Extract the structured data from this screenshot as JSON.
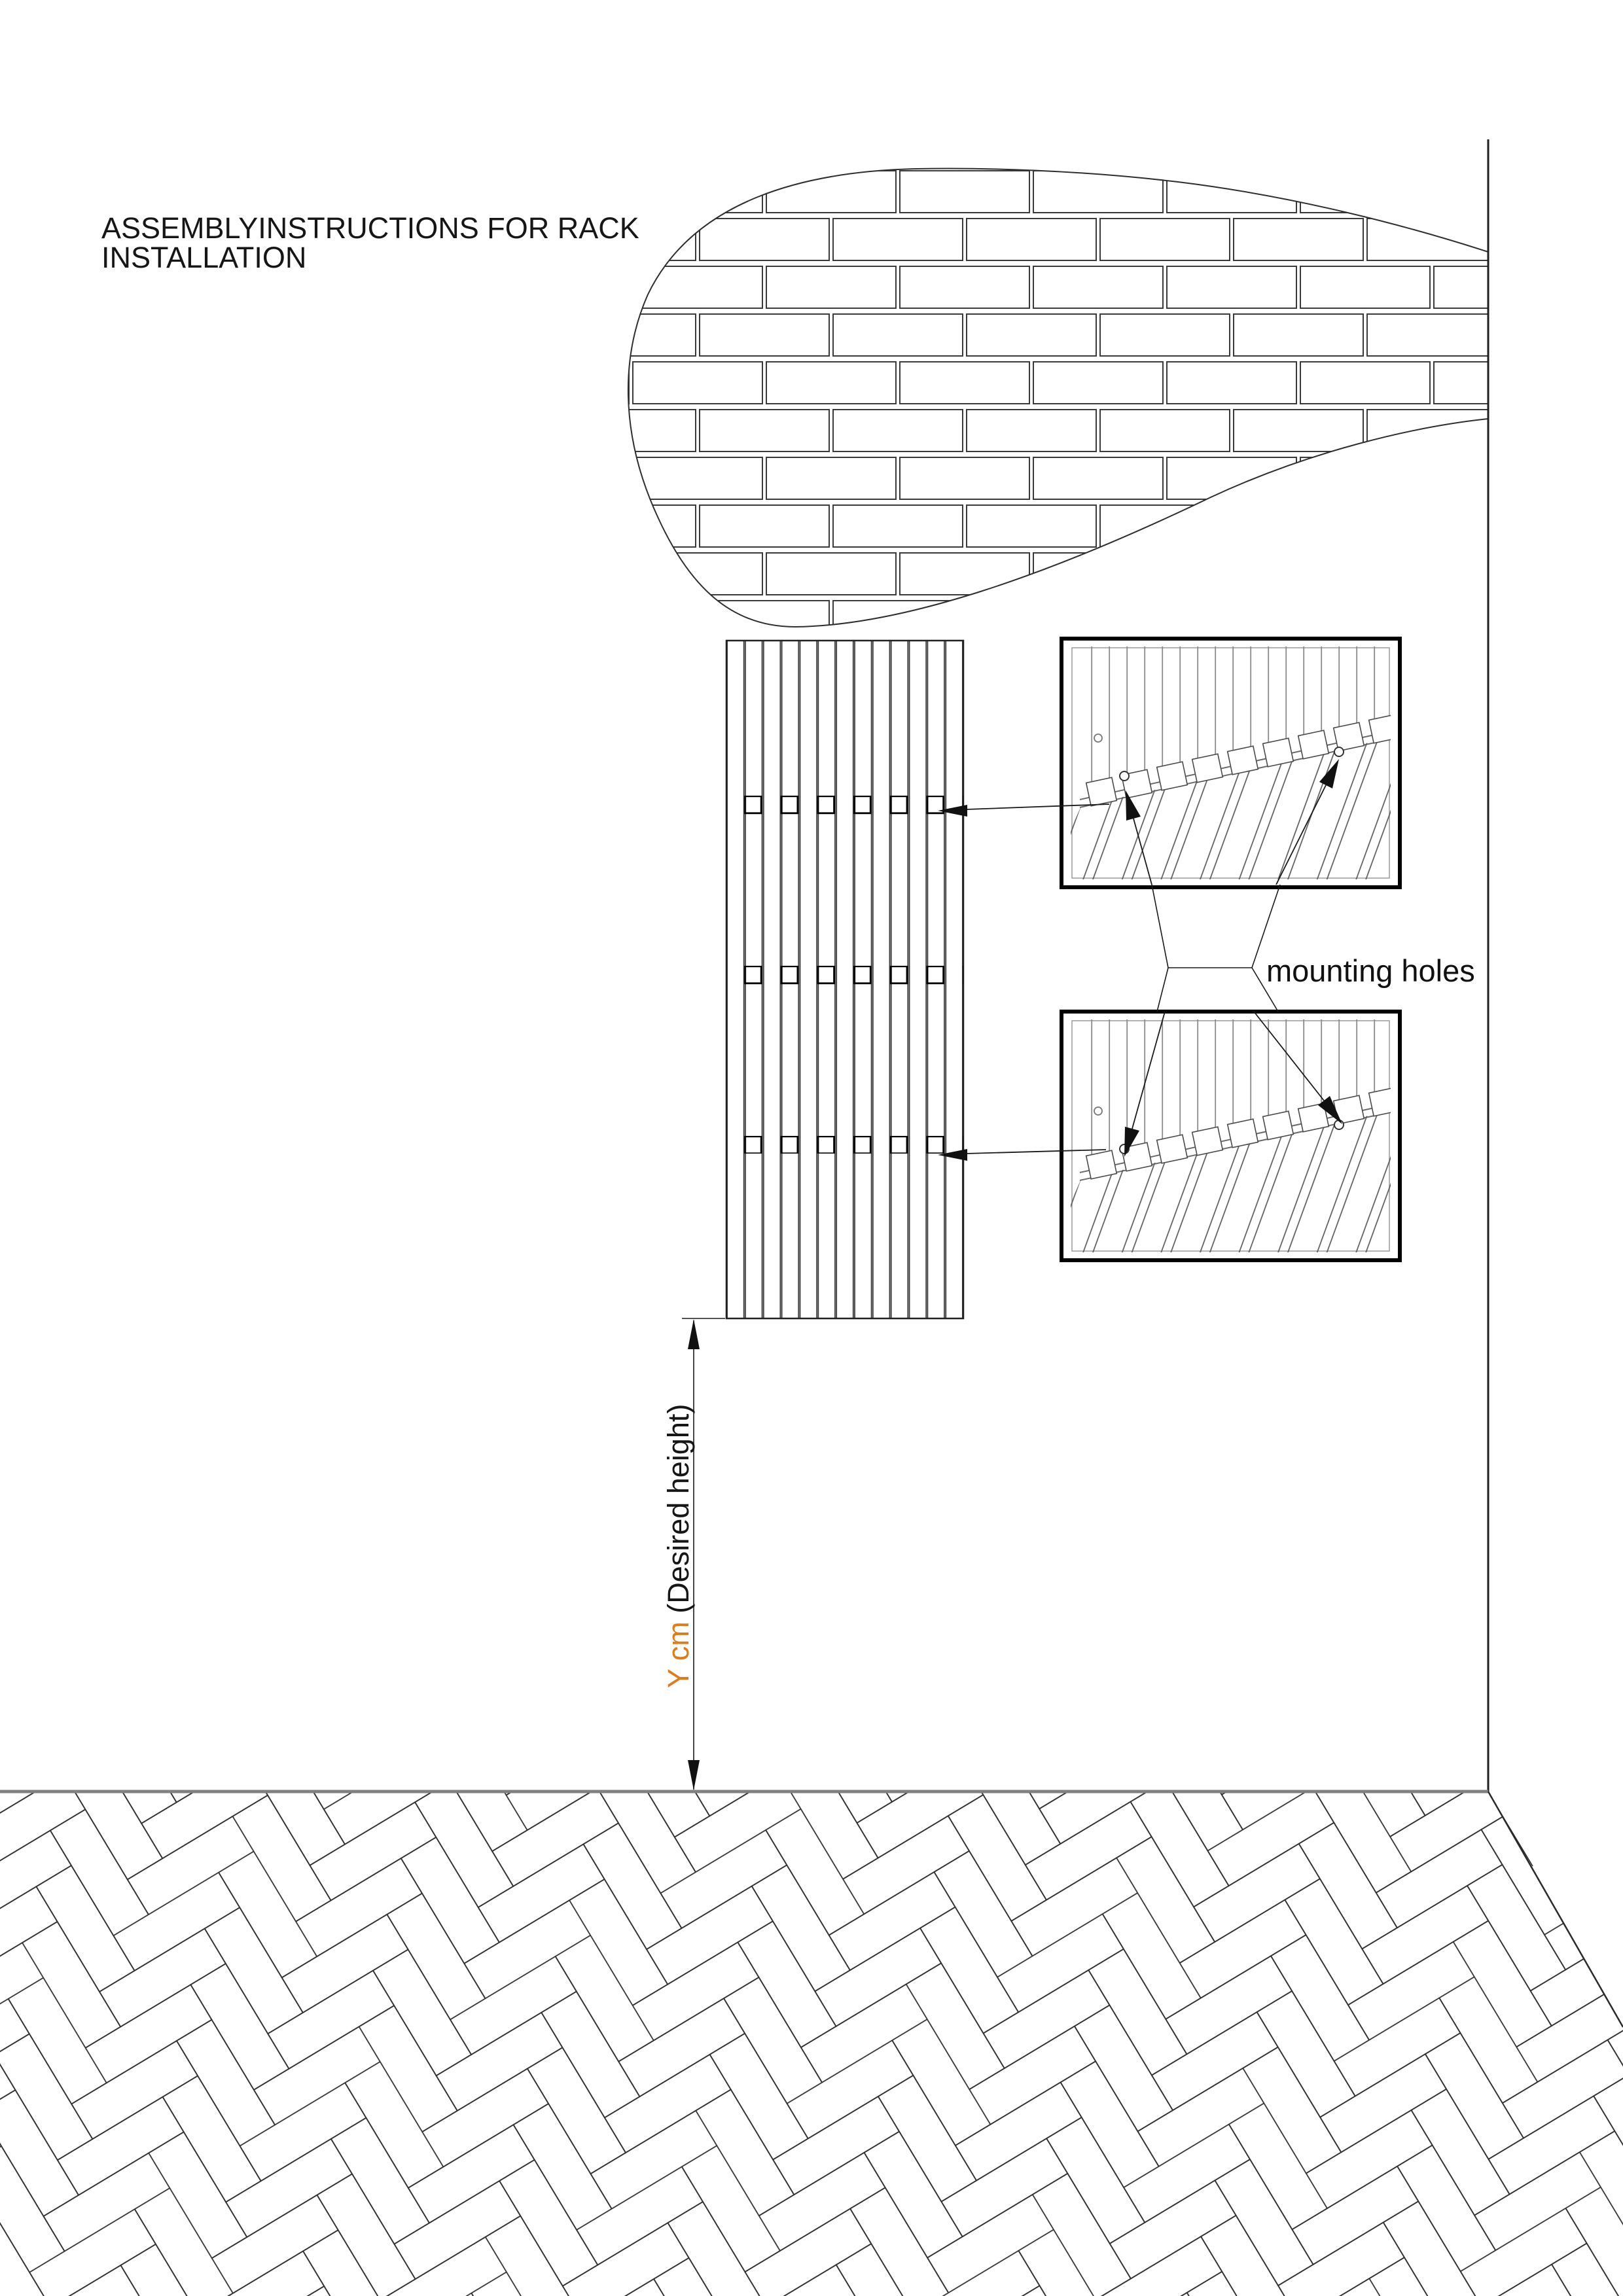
{
  "page": {
    "bg": "#ffffff"
  },
  "title": {
    "line1": "ASSEMBLYINSTRUCTIONS FOR RACK",
    "line2": "INSTALLATION"
  },
  "labels": {
    "mounting_holes": "mounting holes",
    "dimension_value": "Y cm",
    "dimension_suffix": " (Desired height)"
  },
  "colors": {
    "dimension_value": "#e07b1a",
    "drawing_line": "#2a2a2a",
    "floor_line": "#808080"
  },
  "figure": {
    "rack_slat_count": 13,
    "mounting_hole_rows": 3,
    "holes_per_row": 6,
    "detail_box_count": 2
  }
}
